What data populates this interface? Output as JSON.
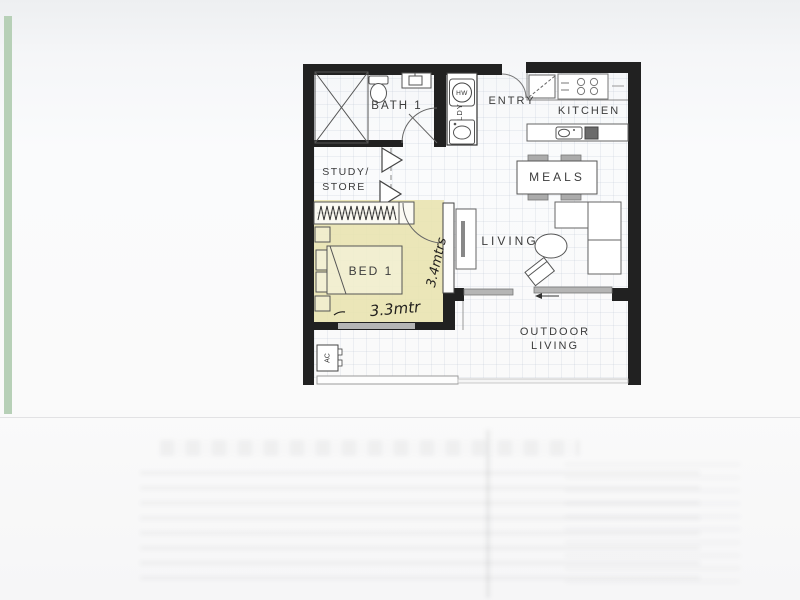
{
  "labels": {
    "bath": "BATH 1",
    "entry": "ENTRY",
    "kitchen": "KITCHEN",
    "study_line1": "STUDY/",
    "study_line2": "STORE",
    "meals": "MEALS",
    "living": "LIVING",
    "bed": "BED 1",
    "outdoor_line1": "OUTDOOR",
    "outdoor_line2": "LIVING",
    "laundry": "LDY",
    "hot_water": "HW",
    "air_con": "AC"
  },
  "handwritten": {
    "bed_width": "3.3mtr",
    "bed_length": "3.4mtrs"
  },
  "colors": {
    "wall": "#212121",
    "bed_highlight": "#e9e3b0",
    "scan_strip": "#b7d0b7",
    "door_panel_gray": "#b5b5b5"
  }
}
